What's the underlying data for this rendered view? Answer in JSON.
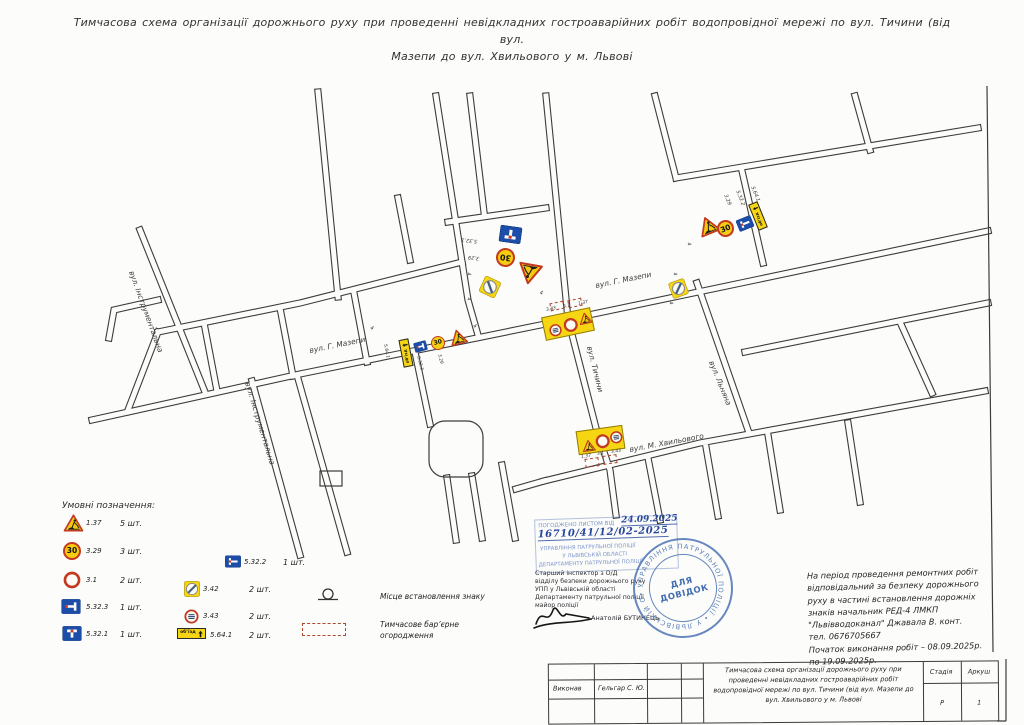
{
  "page": {
    "title_line1": "Тимчасова схема організації дорожнього руху при проведенні невідкладних гостроаварійних робіт водопровідної мережі по вул. Тичини (від вул.",
    "title_line2": "Мазепи до вул. Хвильового у м. Львові"
  },
  "map": {
    "streets": {
      "mazepy_left": "вул. Г. Мазепи",
      "mazepy_right": "вул. Г. Мазепи",
      "tychyny": "вул. Тичини",
      "khvylovoho": "вул. М. Хвильового",
      "instrumentalna_upper": "вул. Інструментальна",
      "instrumentalna_lower": "вул. Інструментальна",
      "lniana": "вул. Льняна"
    },
    "signs": {
      "s137": "1.37",
      "s329": "3.29",
      "s31": "3.1",
      "s342": "3.42",
      "s343": "3.43",
      "s5321": "5.32.1",
      "s5322": "5.32.2",
      "s5323": "5.32.3",
      "s5641": "5.64.1"
    },
    "speed_limit": "30",
    "detour": "об’їзд",
    "distance": "4"
  },
  "legend": {
    "heading": "Умовні позначення:",
    "col1": [
      {
        "code": "1.37",
        "qty": "5 шт."
      },
      {
        "code": "3.29",
        "qty": "3 шт."
      },
      {
        "code": "3.1",
        "qty": "2 шт."
      },
      {
        "code": "5.32.3",
        "qty": "1 шт."
      },
      {
        "code": "5.32.1",
        "qty": "1 шт."
      }
    ],
    "col2": [
      {
        "code": "5.32.2",
        "qty": "1 шт."
      },
      {
        "code": "3.42",
        "qty": "2 шт."
      },
      {
        "code": "3.43",
        "qty": "2 шт."
      },
      {
        "code": "5.64.1",
        "qty": "2 шт."
      }
    ],
    "place_marker": "Місце встановлення знаку",
    "barrier": "Тимчасове бар’єрне огородження"
  },
  "approval_stamp": {
    "agreed": "ПОГОДЖЕНО ЛИСТОМ ВІД",
    "date": "24.09.2025",
    "number": "16710/41/12/02-2025",
    "org_line1": "УПРАВЛІННЯ ПАТРУЛЬНОЇ ПОЛІЦІЇ",
    "org_line2": "У ЛЬВІВСЬКІЙ ОБЛАСТІ",
    "org_line3": "ДЕПАРТАМЕНТУ ПАТРУЛЬНОЇ ПОЛІЦІЇ"
  },
  "signoff": {
    "position_line1": "Старший інспектор з О/Д",
    "position_line2": "відділу безпеки дорожнього руху",
    "position_line3": "УПП у Львівській області",
    "position_line4": "Департаменту патрульної поліції",
    "position_line5": "майор поліції",
    "name": "Анатолій БУТИНЕЦЬ"
  },
  "round_stamp": {
    "center_line1": "ДЛЯ",
    "center_line2": "ДОВІДОК",
    "ring_text": "• УПРАВЛІННЯ ПАТРУЛЬНОЇ ПОЛІЦІЇ • У ЛЬВІВСЬКІЙ ОБЛАСТІ • ДЕПАРТАМЕНТ"
  },
  "notes": {
    "line1": "На період проведення ремонтних робіт",
    "line2": "відповідальний за безпеку дорожнього",
    "line3": "руху в частині встановлення дорожніх",
    "line4": "знаків начальник РЕД-4 ЛМКП",
    "line5": "\"Львівводоканал\" Джавала В.  конт.",
    "line6": "тел. 0676705667",
    "line7": "Початок виконання робіт – 08.09.2025р.",
    "line8": "по 19.09.2025р."
  },
  "titleblock": {
    "executor_label": "Виконав",
    "executor_name": "Гельгар С. Ю.",
    "doc_title": "Тимчасова схема організації дорожнього руху при проведенні невідкладних гостроаварійних робіт водопровідної мережі по вул. Тичини (від вул. Мазепи до вул. Хвильового у м. Львові",
    "stage_label": "Стадія",
    "stage_value": "Р",
    "sheet_label": "Аркуш",
    "sheet_value": "1"
  }
}
